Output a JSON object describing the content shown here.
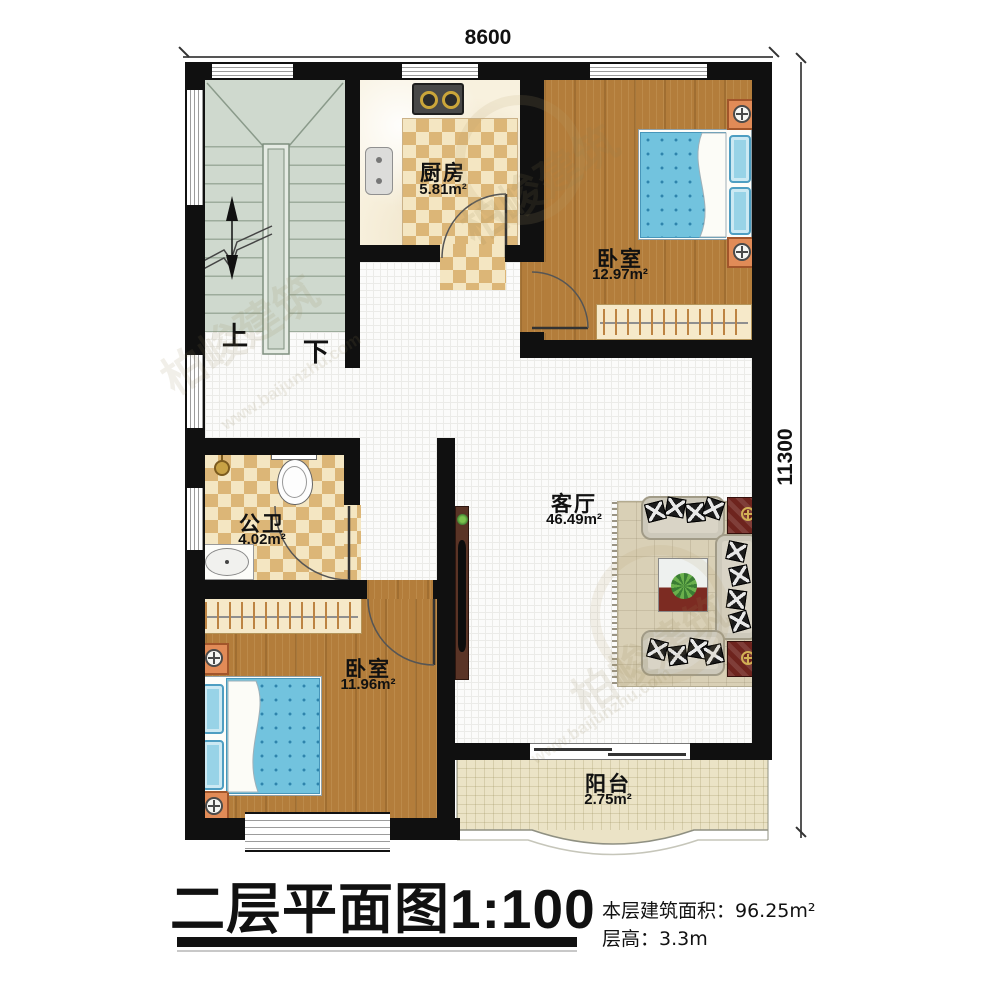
{
  "plan": {
    "dimension_top": "8600",
    "dimension_right": "11300"
  },
  "rooms": {
    "kitchen": {
      "name": "厨房",
      "area": "5.81m²"
    },
    "bedroom1": {
      "name": "卧室",
      "area": "12.97m²"
    },
    "bathroom": {
      "name": "公卫",
      "area": "4.02m²"
    },
    "living": {
      "name": "客厅",
      "area": "46.49m²"
    },
    "bedroom2": {
      "name": "卧室",
      "area": "11.96m²"
    },
    "balcony": {
      "name": "阳台",
      "area": "2.75m²"
    }
  },
  "stairs": {
    "up_label": "上",
    "down_label": "下"
  },
  "footer": {
    "title": "二层平面图",
    "scale": "1:100",
    "area_line": "本层建筑面积：96.25m²",
    "height_line": "层高：3.3m"
  },
  "watermark": {
    "brand": "柏峻建筑",
    "site": "www.baijunzhu.com"
  },
  "colors": {
    "wall": "#101010",
    "wood_floor": "#b37d3b",
    "tile_light": "#f4e6c2",
    "tile_dark": "#dcb677",
    "stair_floor": "#cfd9ce",
    "mattress_blue": "#72c3de",
    "sofa_beige": "#d9d4c6",
    "side_table_red": "#6e241e",
    "balcony_floor": "#ebe3c6"
  }
}
